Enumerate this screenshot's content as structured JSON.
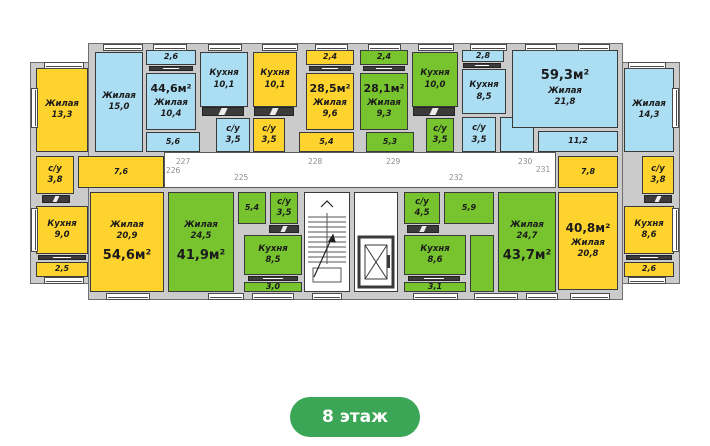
{
  "floor_badge": "8 этаж",
  "colors": {
    "yellow": "#FFD32E",
    "green": "#77C42F",
    "blue": "#ABDDF3",
    "wall": "#CBCBCB",
    "badge": "#3BA656"
  },
  "apartments": {
    "a546": {
      "total": "54,6м²",
      "living1": {
        "label": "Жилая",
        "area": "13,3"
      },
      "su": {
        "label": "с/у",
        "area": "3,8"
      },
      "kitchen": {
        "label": "Кухня",
        "area": "9,0"
      },
      "balcony": "2,5",
      "hall": "7,6",
      "living2": {
        "label": "Жилая",
        "area": "20,9"
      }
    },
    "a446": {
      "total": "44,6м²",
      "living1": {
        "label": "Жилая",
        "area": "15,0"
      },
      "balcony": "2,6",
      "living2": {
        "label": "Жилая",
        "area": "10,4"
      },
      "hall": "5,6",
      "kitchen": {
        "label": "Кухня",
        "area": "10,1"
      },
      "su": {
        "label": "с/у",
        "area": "3,5"
      }
    },
    "a285": {
      "total": "28,5м²",
      "kitchen": {
        "label": "Кухня",
        "area": "10,1"
      },
      "su": {
        "label": "с/у",
        "area": "3,5"
      },
      "balcony": "2,4",
      "living": {
        "label": "Жилая",
        "area": "9,6"
      },
      "hall": "5,4"
    },
    "a281": {
      "total": "28,1м²",
      "balcony": "2,4",
      "living": {
        "label": "Жилая",
        "area": "9,3"
      },
      "kitchen": {
        "label": "Кухня",
        "area": "10,0"
      },
      "su": {
        "label": "с/у",
        "area": "3,5"
      },
      "hall": "5,3"
    },
    "a593": {
      "total": "59,3м²",
      "balcony": "2,8",
      "kitchen": {
        "label": "Кухня",
        "area": "8,5"
      },
      "su": {
        "label": "с/у",
        "area": "3,5"
      },
      "living1": {
        "label": "Жилая",
        "area": "21,8"
      },
      "hall": "11,2",
      "living2": {
        "label": "Жилая",
        "area": "14,3"
      }
    },
    "a419": {
      "total": "41,9м²",
      "living": {
        "label": "Жилая",
        "area": "24,5"
      },
      "hall": "5,4",
      "su": {
        "label": "с/у",
        "area": "3,5"
      },
      "kitchen": {
        "label": "Кухня",
        "area": "8,5"
      },
      "balcony": "3,0"
    },
    "a437": {
      "total": "43,7м²",
      "su": {
        "label": "с/у",
        "area": "4,5"
      },
      "hall": "5,9",
      "kitchen": {
        "label": "Кухня",
        "area": "8,6"
      },
      "balcony": "3,1",
      "living": {
        "label": "Жилая",
        "area": "24,7"
      }
    },
    "a408": {
      "total": "40,8м²",
      "hall": "7,8",
      "su": {
        "label": "с/у",
        "area": "3,8"
      },
      "living": {
        "label": "Жилая",
        "area": "20,8"
      },
      "kitchen": {
        "label": "Кухня",
        "area": "8,6"
      },
      "balcony": "2,6"
    }
  },
  "corridor": {
    "numbers": {
      "n225": "225",
      "n226": "226",
      "n227": "227",
      "n228": "228",
      "n229": "229",
      "n230": "230",
      "n231": "231",
      "n232": "232"
    }
  }
}
